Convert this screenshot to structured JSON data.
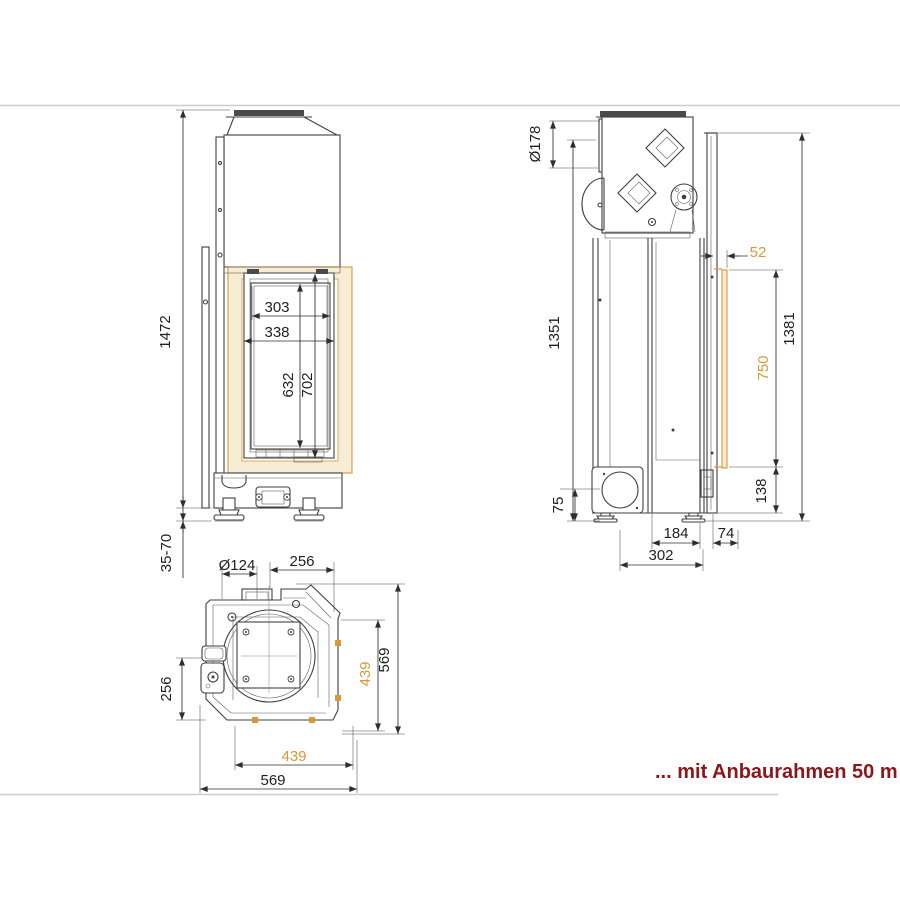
{
  "colors": {
    "accent": "#d9983b",
    "note": "#8b171b",
    "line": "#3f3f3f",
    "gray_rule": "#cccccc"
  },
  "note": {
    "text": "... mit Anbaurahmen 50 m"
  },
  "front_view": {
    "dims": {
      "total_height": "1472",
      "foot_adjust": "35-70",
      "glass_width": "303",
      "door_width": "338",
      "glass_height": "632",
      "door_height": "702"
    }
  },
  "side_view": {
    "dims": {
      "flue_diameter": "Ø178",
      "rear_height": "1351",
      "front_height": "1381",
      "frame_offset": "52",
      "frame_height": "750",
      "frame_bottom_offset": "138",
      "base_height": "75",
      "foot_spacing": "184",
      "front_clearance": "74",
      "base_depth": "302"
    }
  },
  "top_view": {
    "dims": {
      "inlet_diameter": "Ø124",
      "center_to_side": "256",
      "side_offset": "256",
      "frame_width_right": "439",
      "overall_depth": "569",
      "frame_width_front": "439",
      "overall_width": "569"
    }
  }
}
